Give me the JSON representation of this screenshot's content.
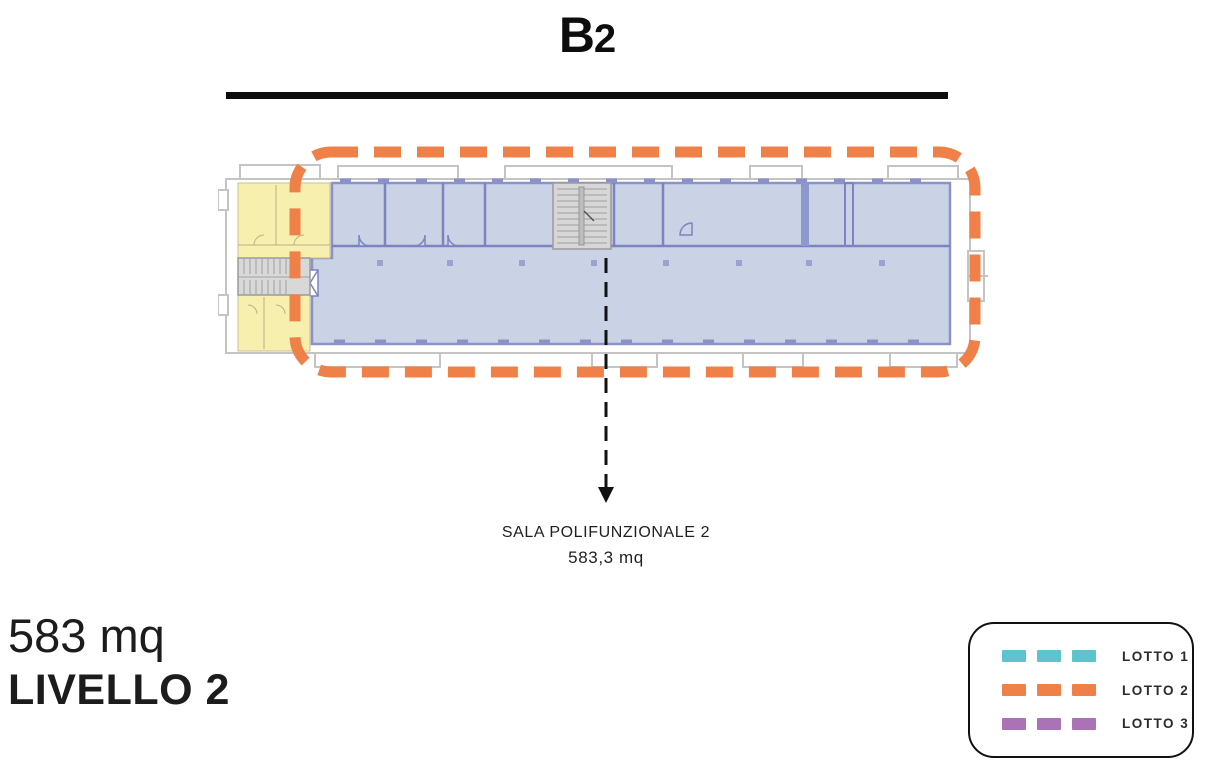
{
  "title": {
    "main": "B",
    "sub": "2"
  },
  "plan": {
    "callout": {
      "line1": "SALA POLIFUNZIONALE 2",
      "line2": "583,3 mq"
    }
  },
  "info": {
    "area": "583 mq",
    "level": "LIVELLO 2"
  },
  "legend": {
    "items": [
      {
        "label": "LOTTO 1",
        "color": "#5fc3cd"
      },
      {
        "label": "LOTTO 2",
        "color": "#ef8148"
      },
      {
        "label": "LOTTO 3",
        "color": "#a973b5"
      }
    ]
  },
  "colors": {
    "lotto1": "#5fc3cd",
    "lotto2": "#ef8148",
    "lotto3": "#a973b5",
    "plan_fill": "#c9d3e5",
    "plan_wall": "#8a92c8",
    "service_fill": "#f6efae",
    "stair_fill": "#d8d8d8",
    "outline_gray": "#c4c4c4",
    "arrow_black": "#111111"
  }
}
